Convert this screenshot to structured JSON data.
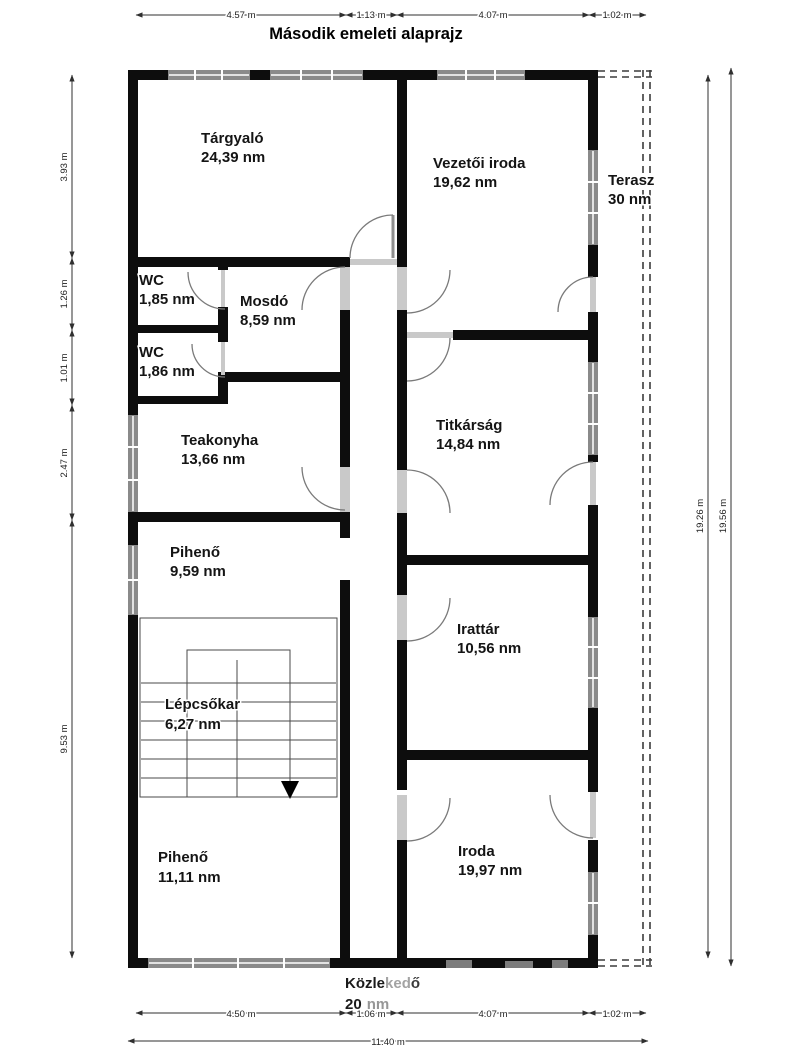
{
  "title": "Második emeleti alaprajz",
  "rooms": [
    {
      "name": "Tárgyaló",
      "area": "24,39 nm"
    },
    {
      "name": "Vezetői iroda",
      "area": "19,62 nm"
    },
    {
      "name": "Terasz",
      "area": "30 nm"
    },
    {
      "name": "WC",
      "area": "1,85 nm"
    },
    {
      "name": "Mosdó",
      "area": "8,59 nm"
    },
    {
      "name": "WC",
      "area": "1,86 nm"
    },
    {
      "name": "Teakonyha",
      "area": "13,66 nm"
    },
    {
      "name": "Titkárság",
      "area": "14,84 nm"
    },
    {
      "name": "Pihenő",
      "area": "9,59 nm"
    },
    {
      "name": "Irattár",
      "area": "10,56 nm"
    },
    {
      "name": "Lépcsőkar",
      "area": "6,27 nm"
    },
    {
      "name": "Pihenő",
      "area": "11,11 nm"
    },
    {
      "name": "Iroda",
      "area": "19,97 nm"
    }
  ],
  "corridor": {
    "name_a": "Közle",
    "name_b": "ked",
    "name_c": "ő",
    "area_a": "20",
    "area_b": "nm"
  },
  "dimensions": {
    "top": [
      "4.57 m",
      "1.13 m",
      "4.07 m",
      "1.02 m"
    ],
    "bottom": [
      "4.50 m",
      "1.06 m",
      "4.07 m",
      "1.02 m"
    ],
    "bottom_total": "11.40 m",
    "left": [
      "3.93 m",
      "1.26 m",
      "1.01 m",
      "2.47 m",
      "9.53 m"
    ],
    "right_inner": "19.26 m",
    "right_outer": "19.56 m"
  },
  "colors": {
    "wall": "#0d0d0d",
    "window": "#8a8a8a",
    "threshold": "#c9c9c9",
    "dashed": "#3c3c3c"
  }
}
